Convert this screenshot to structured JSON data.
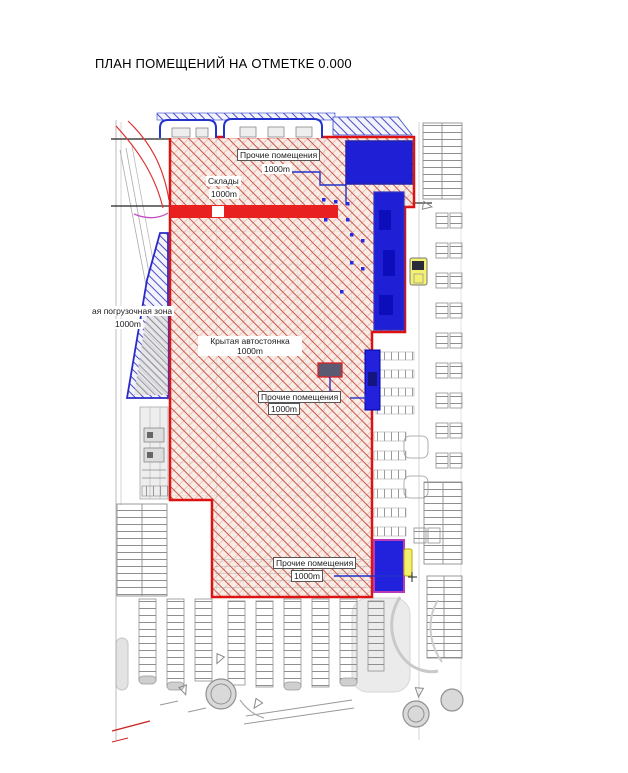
{
  "page": {
    "title": "ПЛАН ПОМЕЩЕНИЙ НА ОТМЕТКЕ 0.000"
  },
  "plan": {
    "rooms": [
      {
        "name": "Прочие помещения",
        "area": "1000m"
      },
      {
        "name": "Склады",
        "area": "1000m"
      },
      {
        "name": "Крытая автостоянка",
        "area": "1000m"
      },
      {
        "name": "Прочие помещения",
        "area": "1000m"
      },
      {
        "name": "ая погрузочная зона",
        "area": "1000m"
      },
      {
        "name": "Прочие помещения",
        "area": "1000m"
      }
    ],
    "colors": {
      "building_outline": "#dd2222",
      "premises_hatch": "#c9584a",
      "blue_block": "#2222d6",
      "loading_zone_outline": "#2a2ac8",
      "bottom_block_outline": "#b73bb7",
      "highlight_yellow": "#f4f170",
      "parking_gray": "#8f8f8f"
    }
  }
}
